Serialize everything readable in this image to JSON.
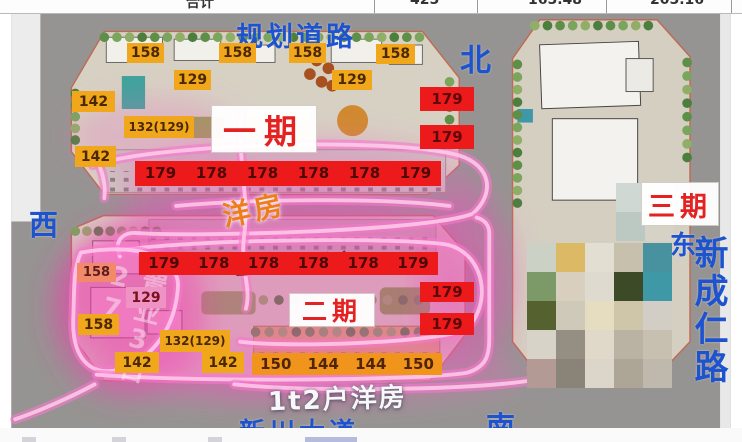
{
  "colors": {
    "blue_annotation": "#1d53cf",
    "phase_red": "#e42222",
    "label_yellow_bg": "#f1a71b",
    "label_red_bg": "#ec1a1a",
    "band_orange_bg": "#f0941c",
    "highlighter_pink": "#f878cd"
  },
  "top_strip": {
    "cells": [
      {
        "text": "合计",
        "x": 186
      },
      {
        "text": "425",
        "x": 410
      },
      {
        "text": "165.48",
        "x": 528
      },
      {
        "text": "205.16",
        "x": 650
      }
    ]
  },
  "compass": {
    "north": "北",
    "west": "西",
    "south": "南",
    "east": "东"
  },
  "roads": {
    "top": "规划道路",
    "bottom": "新川大道",
    "right": "新成仁路"
  },
  "phases": {
    "one": "一期",
    "two": "二期",
    "three": "三期"
  },
  "annotations": {
    "yangfang": "洋房",
    "type_2t2": "2t2户 洋房",
    "type_1t2": "1t2户洋房",
    "watermark": "置业3日27"
  },
  "price_labels": {
    "yellow": [
      {
        "v": "158",
        "x": 127,
        "y": 43,
        "w": 37,
        "h": 20
      },
      {
        "v": "158",
        "x": 219,
        "y": 43,
        "w": 37,
        "h": 20
      },
      {
        "v": "158",
        "x": 289,
        "y": 43,
        "w": 37,
        "h": 20
      },
      {
        "v": "158",
        "x": 376,
        "y": 44,
        "w": 39,
        "h": 20
      },
      {
        "v": "129",
        "x": 174,
        "y": 70,
        "w": 37,
        "h": 20
      },
      {
        "v": "129",
        "x": 332,
        "y": 70,
        "w": 40,
        "h": 20
      },
      {
        "v": "142",
        "x": 72,
        "y": 91,
        "w": 43,
        "h": 21
      },
      {
        "v": "132(129)",
        "x": 124,
        "y": 116,
        "w": 70,
        "h": 22
      },
      {
        "v": "142",
        "x": 75,
        "y": 146,
        "w": 41,
        "h": 21
      },
      {
        "v": "158",
        "x": 77,
        "y": 263,
        "w": 39,
        "h": 19,
        "cls": "tint-a"
      },
      {
        "v": "129",
        "x": 126,
        "y": 287,
        "w": 40,
        "h": 21,
        "cls": "tint-b"
      },
      {
        "v": "158",
        "x": 78,
        "y": 314,
        "w": 41,
        "h": 21
      },
      {
        "v": "132(129)",
        "x": 160,
        "y": 330,
        "w": 70,
        "h": 22
      },
      {
        "v": "142",
        "x": 115,
        "y": 352,
        "w": 44,
        "h": 21
      },
      {
        "v": "142",
        "x": 202,
        "y": 352,
        "w": 42,
        "h": 21
      }
    ],
    "red": [
      {
        "v": "179",
        "x": 420,
        "y": 87,
        "w": 54,
        "h": 24
      },
      {
        "v": "179",
        "x": 420,
        "y": 125,
        "w": 54,
        "h": 24
      },
      {
        "v": "179",
        "x": 420,
        "y": 282,
        "w": 54,
        "h": 20
      },
      {
        "v": "179",
        "x": 420,
        "y": 313,
        "w": 54,
        "h": 22
      }
    ],
    "bands": [
      {
        "cls": "red",
        "x": 135,
        "y": 161,
        "w": 306,
        "h": 25,
        "values": [
          "179",
          "178",
          "178",
          "178",
          "178",
          "179"
        ]
      },
      {
        "cls": "red",
        "x": 139,
        "y": 252,
        "w": 299,
        "h": 23,
        "values": [
          "179",
          "178",
          "178",
          "178",
          "178",
          "179"
        ]
      },
      {
        "cls": "orange",
        "x": 252,
        "y": 353,
        "w": 190,
        "h": 22,
        "values": [
          "150",
          "144",
          "144",
          "150"
        ]
      }
    ]
  },
  "mosaic": {
    "x": 527,
    "y": 243,
    "cell": 29,
    "cols": 5,
    "rows": 5,
    "palette": [
      "#ccd1c6",
      "#dcb964",
      "#e2ded2",
      "#c7c0ac",
      "#47929e",
      "#7b9a68",
      "#d8cfbf",
      "#dedad0",
      "#3c4a28",
      "#3f98a6",
      "#55622f",
      "#cfc9ba",
      "#e6ddc0",
      "#cfc5a8",
      "#d2cec6",
      "#d8d3c9",
      "#958f83",
      "#e0d8c8",
      "#bab2a2",
      "#c7bfb0",
      "#b39a94",
      "#8a8478",
      "#dcd6ca",
      "#ada595",
      "#bfb9ad"
    ],
    "extra": {
      "x": 616,
      "y": 183,
      "cell": 29,
      "cols": 2,
      "rows": 2,
      "palette": [
        "#cfd8d2",
        "#e3ded2",
        "#bcc8c2",
        "#d7d2c6"
      ]
    }
  }
}
